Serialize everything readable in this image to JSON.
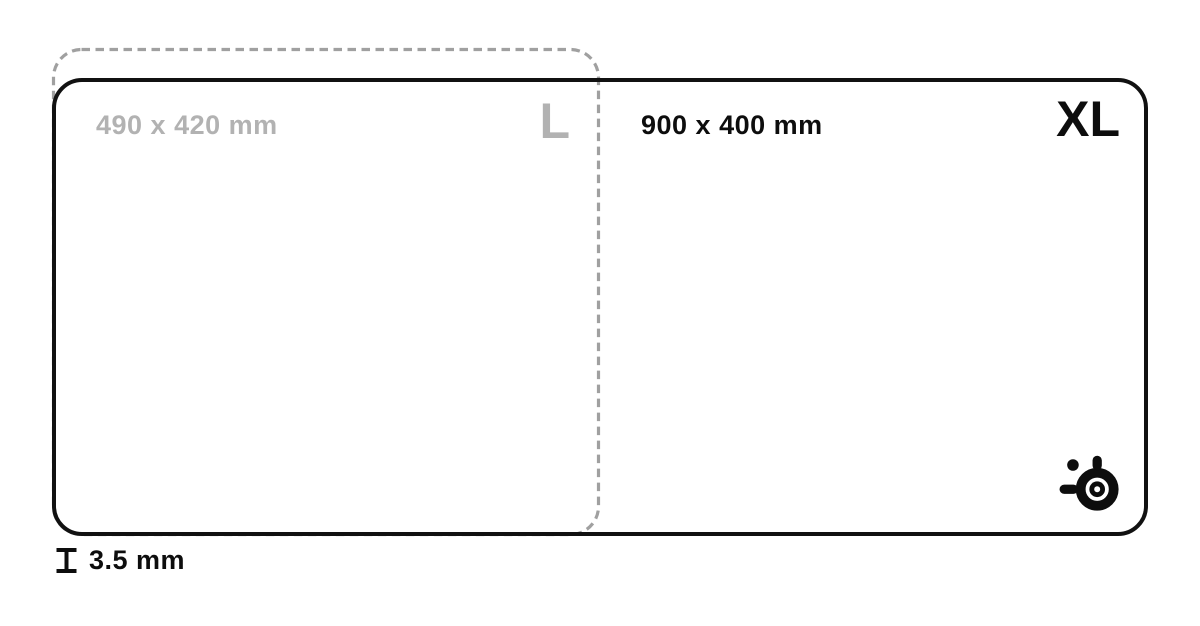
{
  "pads": {
    "l": {
      "dimensions": "490 x 420 mm",
      "size_label": "L",
      "outline_style": "dashed"
    },
    "xl": {
      "dimensions": "900 x 400 mm",
      "size_label": "XL",
      "outline_style": "solid"
    }
  },
  "thickness": {
    "value": "3.5 mm"
  },
  "icons": {
    "brand": "steelseries-logo-icon",
    "thickness": "pad-thickness-icon"
  },
  "colors": {
    "background": "#ffffff",
    "outline": "#111111",
    "dash": "#a0a0a0",
    "muted_text": "#b2b2b2",
    "dark_text": "#0d0d0d"
  }
}
